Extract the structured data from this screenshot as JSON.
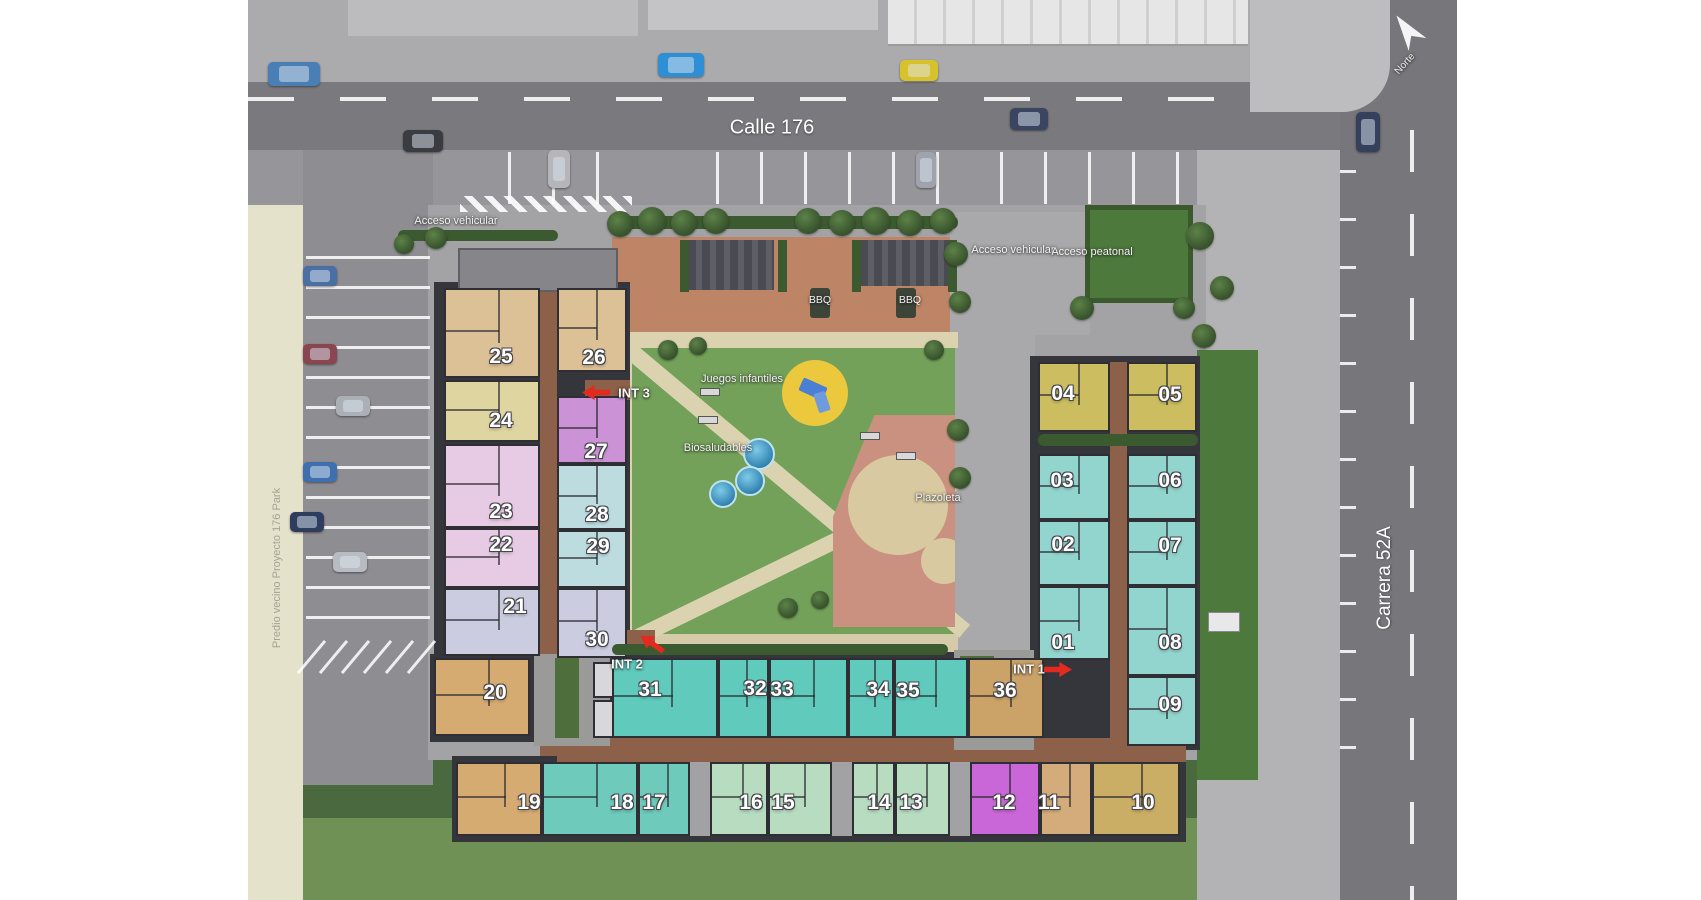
{
  "streets": {
    "calle": "Calle 176",
    "carrera": "Carrera 52A"
  },
  "north_label": "Norte",
  "neighbor_label": "Predio vecino Proyecto 176 Park",
  "access": {
    "west": "Acceso vehicular",
    "vehicular": "Acceso vehicular",
    "peatonal": "Acceso peatonal"
  },
  "amenities": {
    "bbq1": "BBQ",
    "bbq2": "BBQ",
    "juegos": "Juegos infantiles",
    "biosaludables": "Biosaludables",
    "plazoleta": "Plazoleta"
  },
  "int_markers": [
    {
      "label": "INT 3",
      "x": 386,
      "y": 393,
      "arrow_x": 348,
      "arrow_y": 392,
      "dir": "left"
    },
    {
      "label": "INT 2",
      "x": 379,
      "y": 664,
      "arrow_x": 404,
      "arrow_y": 643,
      "dir": "down-left"
    },
    {
      "label": "INT 1",
      "x": 781,
      "y": 669,
      "arrow_x": 810,
      "arrow_y": 669,
      "dir": "right"
    }
  ],
  "units": [
    {
      "id": "25",
      "x": 196,
      "y": 288,
      "w": 96,
      "h": 90,
      "c": "#dcc096",
      "lx": 253,
      "ly": 357
    },
    {
      "id": "26",
      "x": 309,
      "y": 288,
      "w": 70,
      "h": 84,
      "c": "#dcc096",
      "lx": 346,
      "ly": 358
    },
    {
      "id": "24",
      "x": 196,
      "y": 380,
      "w": 96,
      "h": 62,
      "c": "#ded5a0",
      "lx": 253,
      "ly": 421
    },
    {
      "id": "27",
      "x": 309,
      "y": 396,
      "w": 70,
      "h": 68,
      "c": "#cb93d6",
      "lx": 348,
      "ly": 452
    },
    {
      "id": "23",
      "x": 196,
      "y": 444,
      "w": 96,
      "h": 84,
      "c": "#e7cbe5",
      "lx": 253,
      "ly": 512
    },
    {
      "id": "28",
      "x": 309,
      "y": 464,
      "w": 70,
      "h": 66,
      "c": "#bcdce0",
      "lx": 349,
      "ly": 515
    },
    {
      "id": "22",
      "x": 196,
      "y": 528,
      "w": 96,
      "h": 60,
      "c": "#e7cbe5",
      "lx": 253,
      "ly": 545
    },
    {
      "id": "29",
      "x": 309,
      "y": 530,
      "w": 70,
      "h": 58,
      "c": "#bcdce0",
      "lx": 350,
      "ly": 547
    },
    {
      "id": "21",
      "x": 196,
      "y": 588,
      "w": 96,
      "h": 68,
      "c": "#cbcce0",
      "lx": 267,
      "ly": 607
    },
    {
      "id": "30",
      "x": 309,
      "y": 588,
      "w": 70,
      "h": 70,
      "c": "#cbcce0",
      "lx": 349,
      "ly": 640
    },
    {
      "id": "20",
      "x": 186,
      "y": 658,
      "w": 96,
      "h": 78,
      "c": "#d6ab72",
      "lx": 247,
      "ly": 693
    },
    {
      "id": "31",
      "x": 364,
      "y": 658,
      "w": 106,
      "h": 80,
      "c": "#60cabc",
      "lx": 402,
      "ly": 690
    },
    {
      "id": "32",
      "x": 470,
      "y": 658,
      "w": 51,
      "h": 80,
      "c": "#60cabc",
      "lx": 507,
      "ly": 689
    },
    {
      "id": "33",
      "x": 521,
      "y": 658,
      "w": 79,
      "h": 80,
      "c": "#60cabc",
      "lx": 534,
      "ly": 690
    },
    {
      "id": "34",
      "x": 600,
      "y": 658,
      "w": 46,
      "h": 80,
      "c": "#60cabc",
      "lx": 630,
      "ly": 690
    },
    {
      "id": "35",
      "x": 646,
      "y": 658,
      "w": 74,
      "h": 80,
      "c": "#60cabc",
      "lx": 660,
      "ly": 691
    },
    {
      "id": "36",
      "x": 720,
      "y": 658,
      "w": 76,
      "h": 80,
      "c": "#cba368",
      "lx": 757,
      "ly": 691
    },
    {
      "id": "04",
      "x": 790,
      "y": 362,
      "w": 72,
      "h": 70,
      "c": "#ccbd60",
      "lx": 815,
      "ly": 394
    },
    {
      "id": "05",
      "x": 879,
      "y": 362,
      "w": 70,
      "h": 70,
      "c": "#ccbd60",
      "lx": 922,
      "ly": 395
    },
    {
      "id": "03",
      "x": 790,
      "y": 454,
      "w": 72,
      "h": 66,
      "c": "#92d4ce",
      "lx": 814,
      "ly": 481
    },
    {
      "id": "06",
      "x": 879,
      "y": 454,
      "w": 70,
      "h": 66,
      "c": "#92d4ce",
      "lx": 922,
      "ly": 481
    },
    {
      "id": "02",
      "x": 790,
      "y": 520,
      "w": 72,
      "h": 66,
      "c": "#92d4ce",
      "lx": 815,
      "ly": 545
    },
    {
      "id": "07",
      "x": 879,
      "y": 520,
      "w": 70,
      "h": 66,
      "c": "#92d4ce",
      "lx": 922,
      "ly": 546
    },
    {
      "id": "01",
      "x": 790,
      "y": 586,
      "w": 72,
      "h": 74,
      "c": "#92d4ce",
      "lx": 815,
      "ly": 643
    },
    {
      "id": "08",
      "x": 879,
      "y": 586,
      "w": 70,
      "h": 90,
      "c": "#92d4ce",
      "lx": 922,
      "ly": 643
    },
    {
      "id": "09",
      "x": 879,
      "y": 676,
      "w": 70,
      "h": 70,
      "c": "#92d4ce",
      "lx": 922,
      "ly": 705
    },
    {
      "id": "19",
      "x": 208,
      "y": 762,
      "w": 86,
      "h": 74,
      "c": "#d6ab72",
      "lx": 281,
      "ly": 803
    },
    {
      "id": "18",
      "x": 294,
      "y": 762,
      "w": 96,
      "h": 74,
      "c": "#6ecabb",
      "lx": 374,
      "ly": 803
    },
    {
      "id": "17",
      "x": 390,
      "y": 762,
      "w": 52,
      "h": 74,
      "c": "#6ecabb",
      "lx": 406,
      "ly": 803
    },
    {
      "id": "16",
      "x": 462,
      "y": 762,
      "w": 58,
      "h": 74,
      "c": "#b7dcc0",
      "lx": 503,
      "ly": 803
    },
    {
      "id": "15",
      "x": 520,
      "y": 762,
      "w": 64,
      "h": 74,
      "c": "#b7dcc0",
      "lx": 535,
      "ly": 803
    },
    {
      "id": "14",
      "x": 604,
      "y": 762,
      "w": 43,
      "h": 74,
      "c": "#b7dcc0",
      "lx": 631,
      "ly": 803
    },
    {
      "id": "13",
      "x": 647,
      "y": 762,
      "w": 55,
      "h": 74,
      "c": "#b7dcc0",
      "lx": 663,
      "ly": 803
    },
    {
      "id": "12",
      "x": 722,
      "y": 762,
      "w": 70,
      "h": 74,
      "c": "#ca67d8",
      "lx": 756,
      "ly": 803
    },
    {
      "id": "11",
      "x": 792,
      "y": 762,
      "w": 52,
      "h": 74,
      "c": "#d4ac7c",
      "lx": 801,
      "ly": 803
    },
    {
      "id": "10",
      "x": 844,
      "y": 762,
      "w": 88,
      "h": 74,
      "c": "#cbae66",
      "lx": 895,
      "ly": 803
    }
  ],
  "colors": {
    "arrow_red": "#e32a1e",
    "road": "#7a7a7e",
    "park_green": "#73a15a",
    "lawn_green": "#4d7a3c",
    "corridor_brown": "#8d6049",
    "plaza_pink": "#cb9180",
    "path_tan": "#dbd2b0",
    "neighbor_beige": "#e5e2cc"
  }
}
